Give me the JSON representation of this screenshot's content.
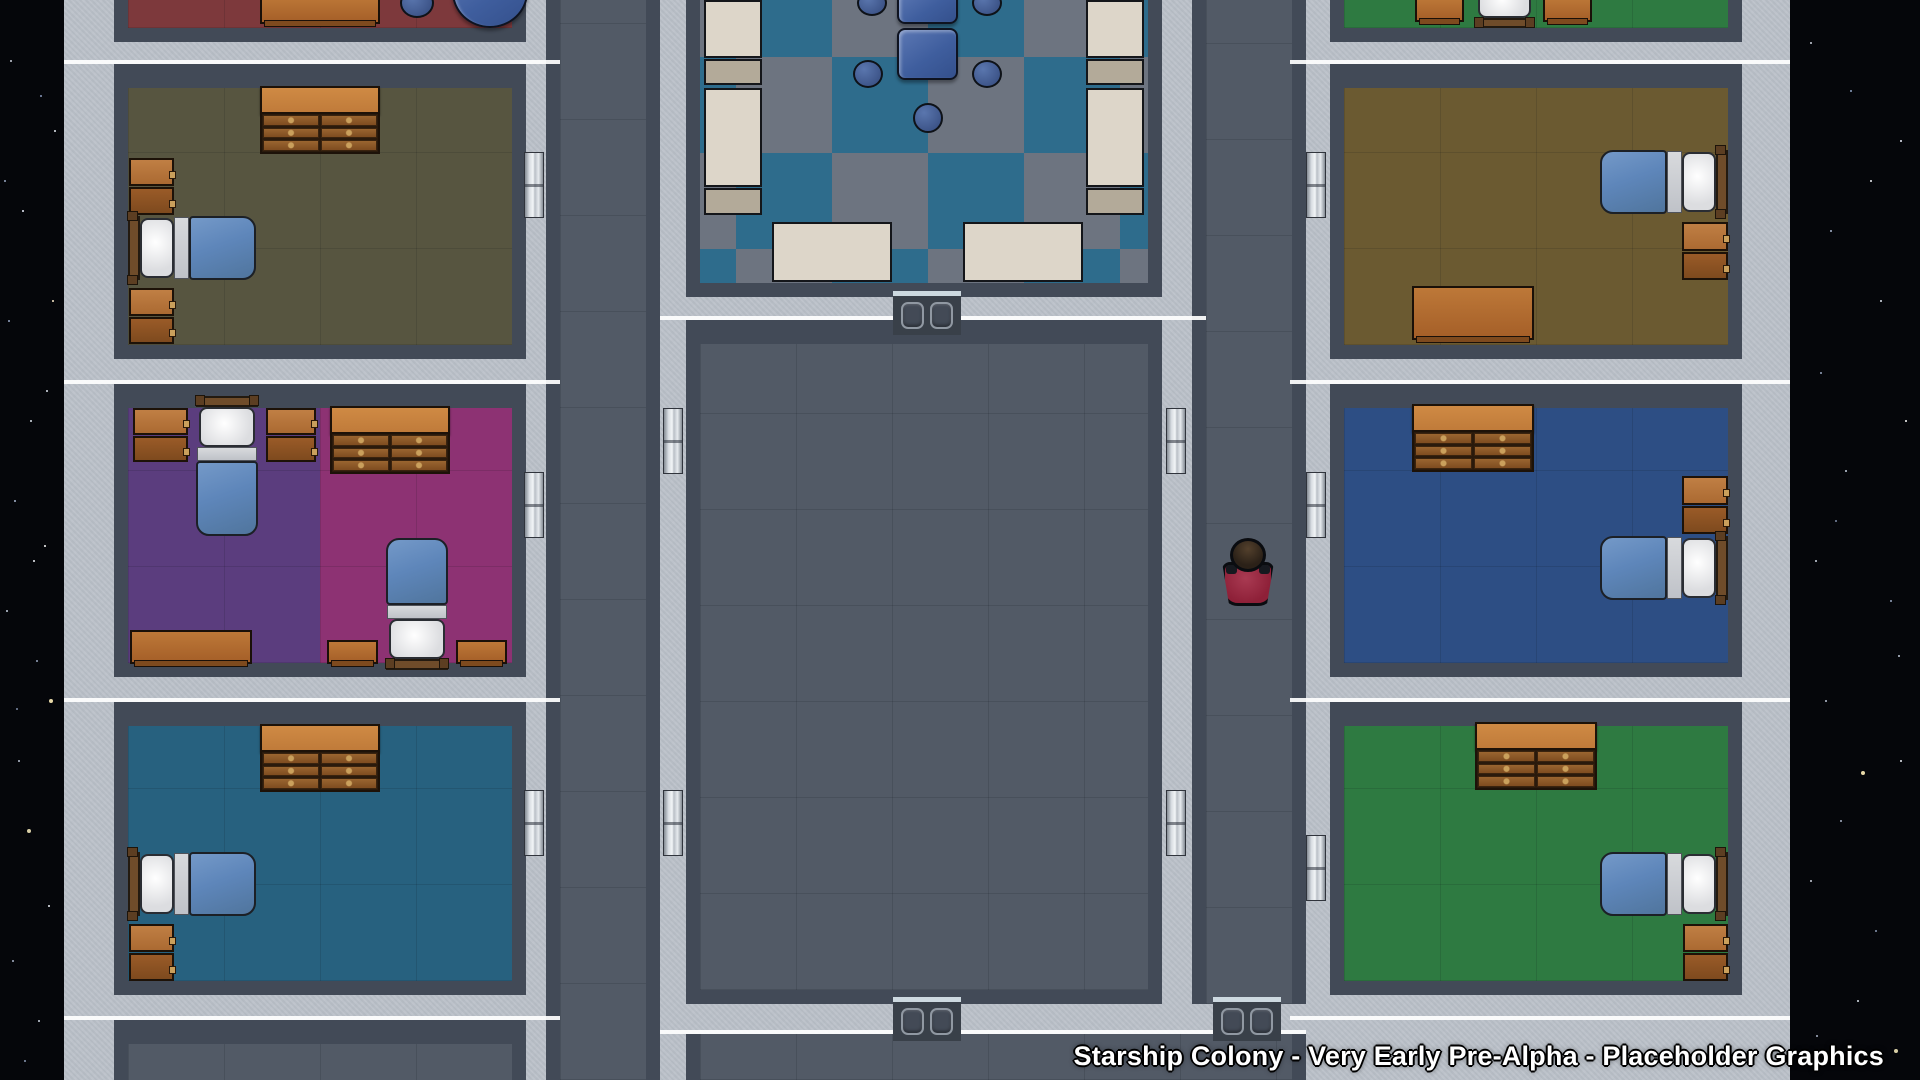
{
  "watermark": {
    "text": "Starship Colony - Very Early Pre-Alpha - Placeholder Graphics"
  },
  "scene": {
    "view": "top-down starship interior",
    "setting": "space with starfield visible on left and right edges"
  },
  "colors": {
    "space": "#05060a",
    "wall": "#b9bfc7",
    "shadow": "#424a57",
    "floorDark": "#525a66",
    "cafA": "#2e6c8c",
    "cafB": "#6d7480",
    "red": "#7d393c",
    "olive": "#575540",
    "purple": "#5b3d7e",
    "magenta": "#8d3273",
    "teal": "#27617f",
    "brown": "#6b5a31",
    "navy": "#2d4e84",
    "green": "#2e7a41",
    "orangeL": "#c07b3a",
    "orange": "#a55f28",
    "drawer": "#7e4c20",
    "knob": "#caa05c",
    "blanket": "#5e86ba",
    "pillow": "#dcdde0",
    "sheet": "#bfc2c8",
    "wood": "#6f4c2a",
    "tblBlue": "#3f5e9e",
    "stool": "#33497c",
    "cream": "#ddd6c9",
    "beige": "#b3aa99",
    "metalA": "#f2f5f7",
    "metalB": "#848b94",
    "panel": "#394049",
    "shirt": "#8e2038",
    "hair": "#2b2118"
  },
  "rooms": [
    {
      "id": "bedroom-red-partial",
      "floor": "#7d393c",
      "furniture": [
        "table",
        "stool",
        "round-table"
      ]
    },
    {
      "id": "bedroom-olive",
      "floor": "#575540",
      "furniture": [
        "dresser",
        "nightstand-pair",
        "bed",
        "nightstand-pair"
      ]
    },
    {
      "id": "bedroom-purple-magenta",
      "floor": "#5b3d7e / #8d3273",
      "furniture": [
        "nightstand",
        "bed",
        "nightstand",
        "dresser",
        "desk",
        "bed",
        "table",
        "table"
      ]
    },
    {
      "id": "bedroom-teal",
      "floor": "#27617f",
      "furniture": [
        "dresser",
        "bed",
        "nightstand-pair"
      ]
    },
    {
      "id": "mess-hall",
      "floor": "checker #2e6c8c/#6d7480",
      "furniture": [
        "fridges",
        "counters",
        "tables",
        "stools",
        "serving-tables"
      ]
    },
    {
      "id": "central-hall",
      "floor": "#525a66",
      "furniture": []
    },
    {
      "id": "bedroom-green-partial",
      "floor": "#2e7a41",
      "furniture": [
        "table",
        "bed-end",
        "table"
      ]
    },
    {
      "id": "bedroom-brown",
      "floor": "#6b5a31",
      "furniture": [
        "bed",
        "nightstand-pair",
        "desk"
      ]
    },
    {
      "id": "bedroom-navy",
      "floor": "#2d4e84",
      "furniture": [
        "dresser",
        "nightstand-pair",
        "bed"
      ]
    },
    {
      "id": "bedroom-green",
      "floor": "#2e7a41",
      "furniture": [
        "dresser",
        "bed",
        "nightstand-pair"
      ]
    },
    {
      "id": "room-lower-left-partial",
      "floor": "#525a66",
      "furniture": []
    }
  ],
  "character": {
    "type": "colonist",
    "shirt": "#8e2038",
    "hair": "#2b2118",
    "location": "east corridor",
    "facing": "north"
  }
}
